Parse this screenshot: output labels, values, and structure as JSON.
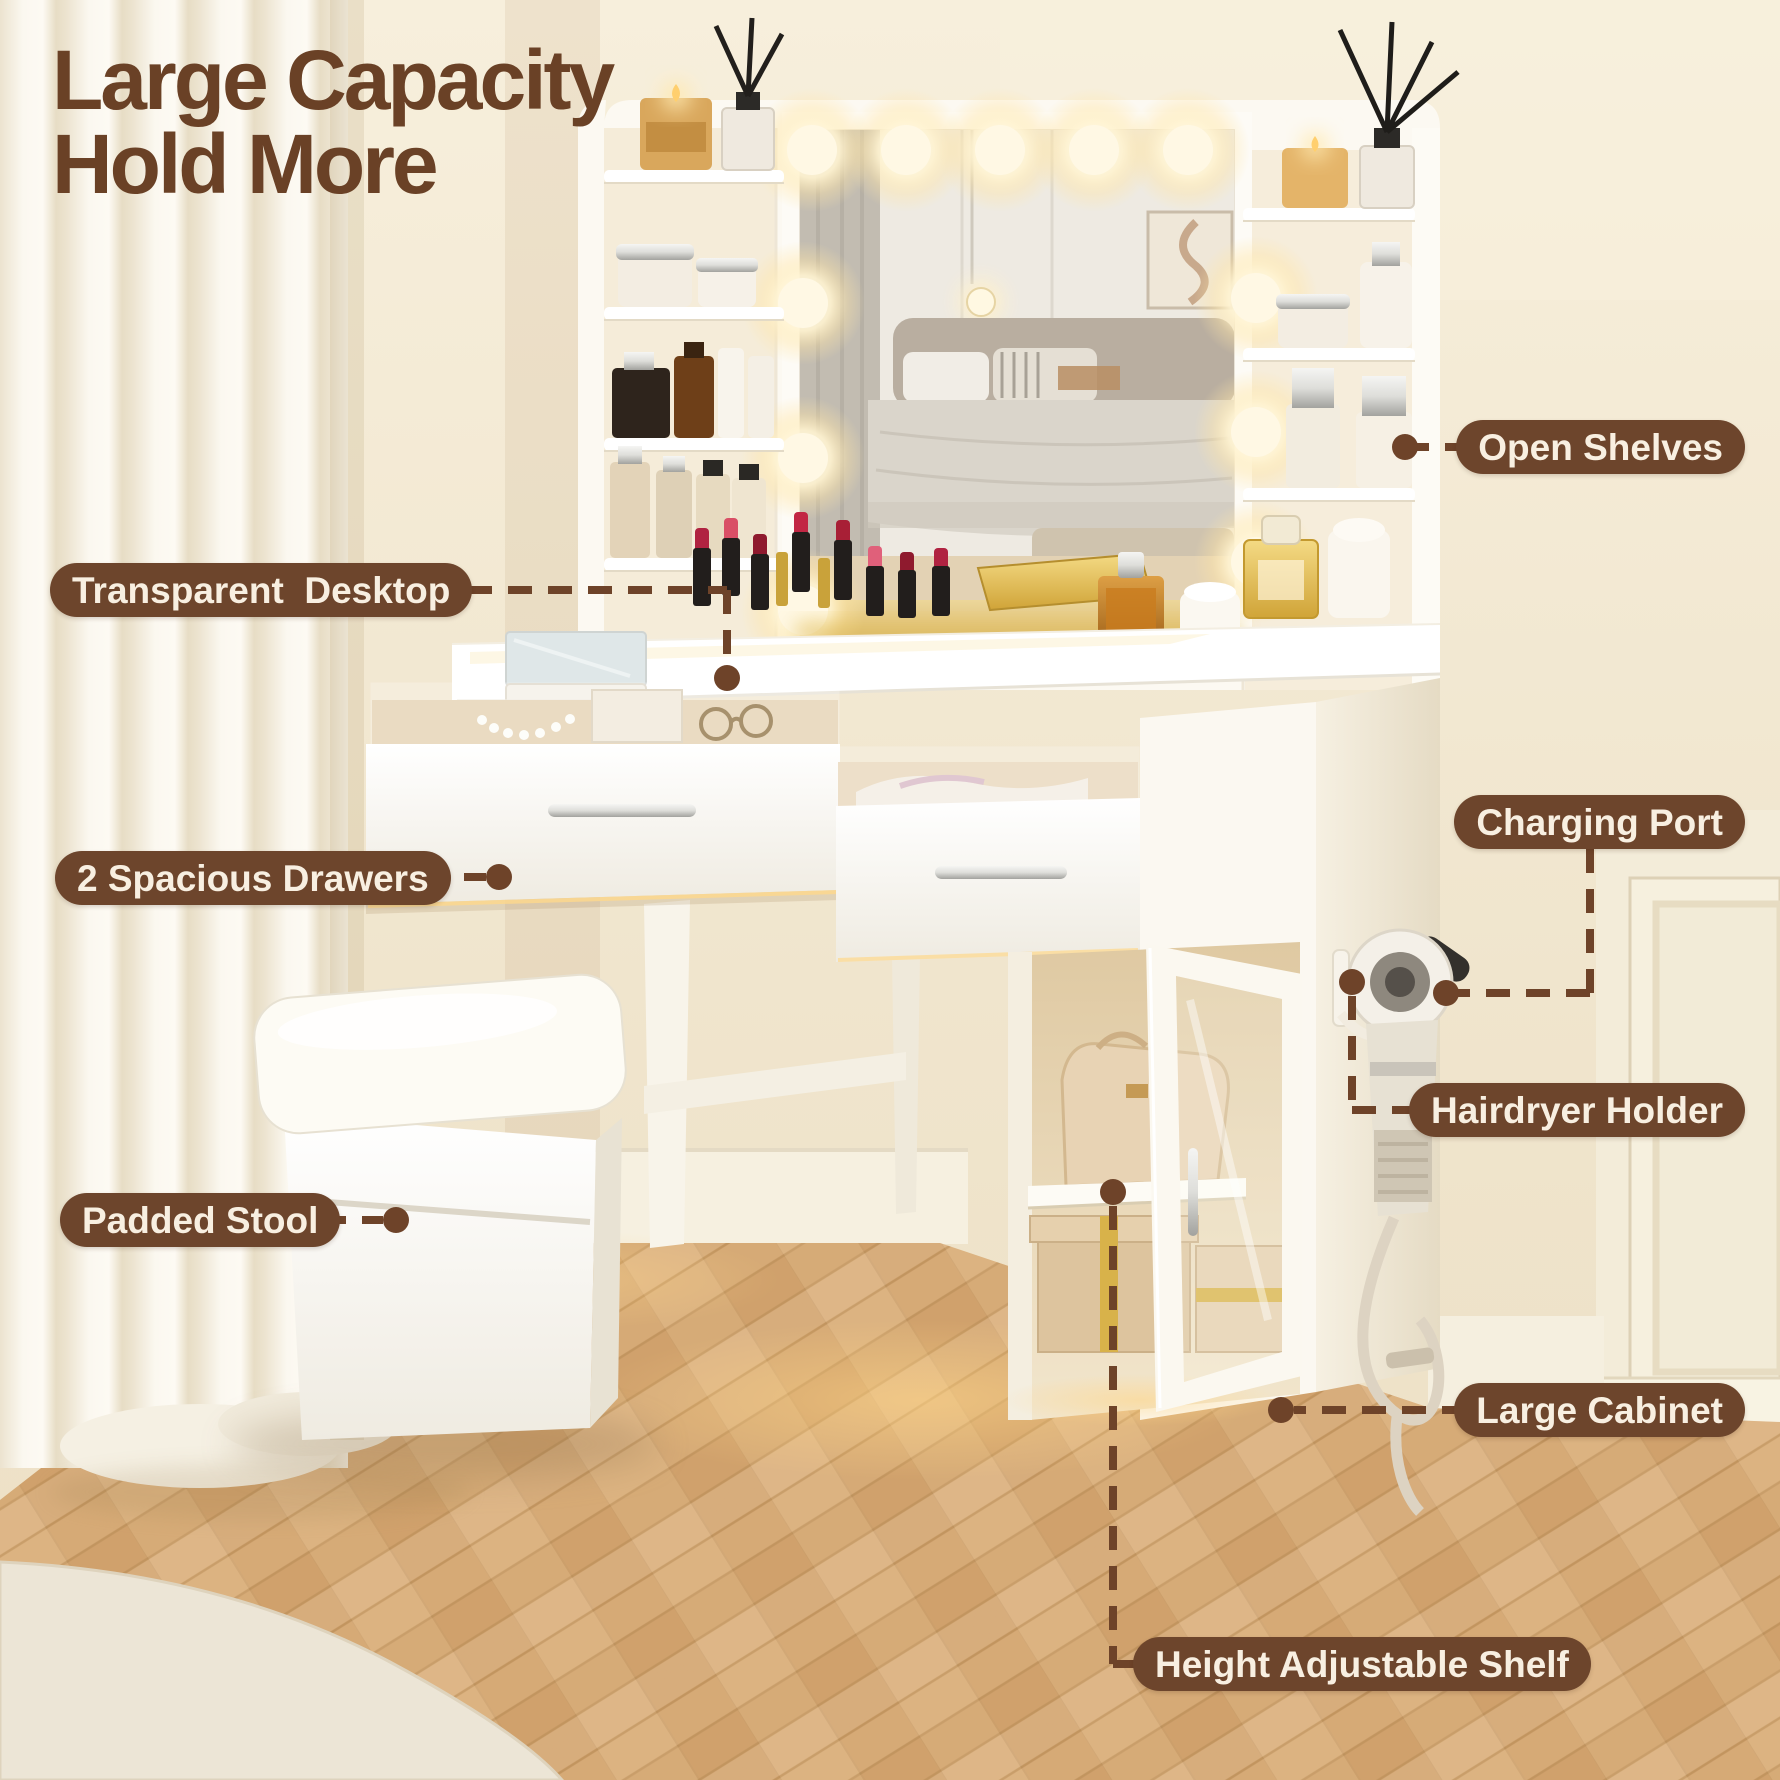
{
  "title": {
    "line1": "Large Capacity",
    "line2": "Hold More"
  },
  "labels": {
    "open_shelves": "Open Shelves",
    "transparent_desktop": "Transparent  Desktop",
    "spacious_drawers": "2 Spacious Drawers",
    "charging_port": "Charging Port",
    "hairdryer_holder": "Hairdryer Holder",
    "padded_stool": "Padded Stool",
    "large_cabinet": "Large Cabinet",
    "height_adjustable_shelf": "Height Adjustable Shelf"
  },
  "colors": {
    "accent_brown": "#6d452c",
    "label_text": "#f8efe1",
    "title_text": "#6a4126",
    "connector": "#6e4329"
  }
}
